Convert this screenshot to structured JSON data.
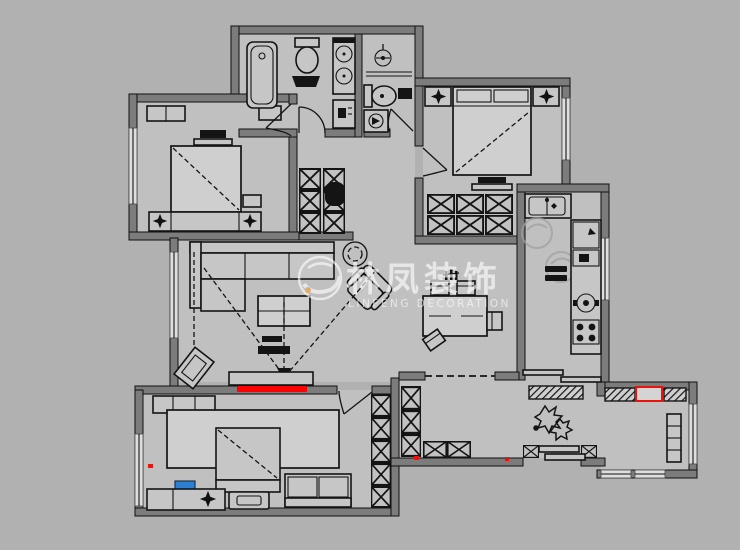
{
  "watermark": {
    "logo_icon": "swoosh-circle-logo",
    "title_cn": "林凤装饰",
    "subtitle_en": "LINFENG DECORATION",
    "dot_color": "#f0a23c"
  },
  "palette": {
    "background": "#b1b1b1",
    "floor": "#c0c0c0",
    "wall_fill": "#7c7c7c",
    "line_black": "#141414",
    "furniture_fill": "#c6c6c6",
    "window_fill": "#dedede",
    "tv_red": "#ff0000",
    "appliance_red_outline": "#e8150e",
    "stool_blue": "#2e7fd2",
    "watermark_white": "rgba(255,255,255,0.6)"
  },
  "rooms": [
    {
      "id": "bedroom-top-left",
      "furniture": [
        "bed",
        "headboard-nightstands",
        "lamps",
        "tv-shelf",
        "stool",
        "window"
      ]
    },
    {
      "id": "bathroom-left",
      "furniture": [
        "bathtub",
        "toilet",
        "double-vanity",
        "bath-mat",
        "cabinet",
        "door"
      ]
    },
    {
      "id": "bathroom-right",
      "furniture": [
        "pedestal-sink",
        "toilet",
        "washing-machine",
        "bath-mat",
        "door"
      ]
    },
    {
      "id": "hallway",
      "furniture": [
        "storage-columns",
        "water-heater"
      ]
    },
    {
      "id": "bedroom-top-right",
      "furniture": [
        "bed",
        "nightstands",
        "lamps",
        "bed-bench",
        "x-wardrobe",
        "door",
        "window"
      ]
    },
    {
      "id": "kitchen",
      "furniture": [
        "sink-counter",
        "fridge",
        "cooktop",
        "side-counter",
        "sliding-door"
      ]
    },
    {
      "id": "living-room",
      "furniture": [
        "sofa",
        "chaise",
        "coffee-table",
        "armchair",
        "round-side-table",
        "tv-console",
        "tv-red",
        "plant-diamond",
        "sight-lines"
      ]
    },
    {
      "id": "dining-area",
      "furniture": [
        "dining-table",
        "chairs",
        "plant-sprig"
      ]
    },
    {
      "id": "master-bedroom",
      "furniture": [
        "bed",
        "quilt",
        "dresser",
        "loveseat",
        "bench",
        "blue-stool",
        "lamp",
        "x-wardrobe",
        "door",
        "window"
      ]
    },
    {
      "id": "entry-hall",
      "furniture": [
        "shoe-cabinet-hatched",
        "decor-plant",
        "x-storage",
        "entry-threshold"
      ]
    },
    {
      "id": "utility-room",
      "furniture": [
        "hatched-cabinets",
        "red-outlined-appliance",
        "radiator",
        "windows"
      ]
    }
  ]
}
